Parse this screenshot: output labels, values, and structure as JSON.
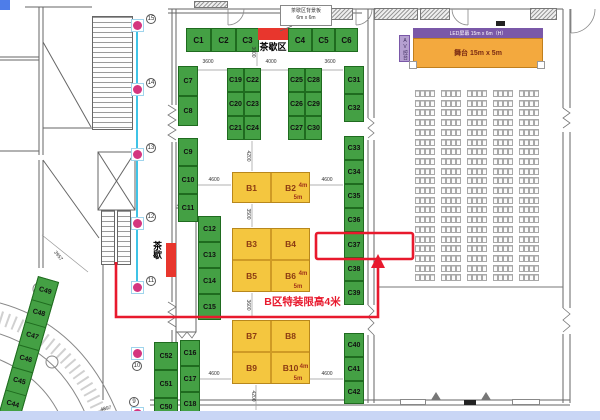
{
  "labels": {
    "tea_area": "茶歇区",
    "tea_annotation_line1": "茶歇区背景板",
    "tea_annotation_line2": "6m x 6m",
    "tea_side_vertical": "茶歇",
    "led_screen": "LED屏幕 15m x 6m（H）",
    "stage": "舞台 15m x 5m",
    "av_console": "AV控台",
    "height_limit_note": "B区特装限高4米"
  },
  "highlight": {
    "booth": "C37"
  },
  "colors": {
    "booth_green": "#44a044",
    "booth_yellow": "#f4c63f",
    "accent_red": "#e8192d",
    "marker_pink": "#d4367f",
    "marker_cyan": "#3fc3e6",
    "stage_orange": "#f3a93e",
    "led_purple": "#7a58a8",
    "bottom_bar": "#c9d6f5"
  },
  "green_booths": [
    {
      "id": "C1",
      "x": 186,
      "y": 28,
      "w": 25,
      "h": 24,
      "top": true
    },
    {
      "id": "C2",
      "x": 211,
      "y": 28,
      "w": 25,
      "h": 24,
      "top": true
    },
    {
      "id": "C3",
      "x": 236,
      "y": 28,
      "w": 23,
      "h": 24,
      "top": true
    },
    {
      "id": "C4",
      "x": 288,
      "y": 28,
      "w": 24,
      "h": 24,
      "top": true
    },
    {
      "id": "C5",
      "x": 312,
      "y": 28,
      "w": 23,
      "h": 24,
      "top": true
    },
    {
      "id": "C6",
      "x": 335,
      "y": 28,
      "w": 23,
      "h": 24,
      "top": true
    },
    {
      "id": "C7",
      "x": 178,
      "y": 66,
      "w": 20,
      "h": 30
    },
    {
      "id": "C8",
      "x": 178,
      "y": 96,
      "w": 20,
      "h": 30
    },
    {
      "id": "C9",
      "x": 178,
      "y": 138,
      "w": 20,
      "h": 28
    },
    {
      "id": "C10",
      "x": 178,
      "y": 166,
      "w": 20,
      "h": 28
    },
    {
      "id": "C11",
      "x": 178,
      "y": 194,
      "w": 20,
      "h": 28
    },
    {
      "id": "C12",
      "x": 198,
      "y": 216,
      "w": 23,
      "h": 26
    },
    {
      "id": "C13",
      "x": 198,
      "y": 242,
      "w": 23,
      "h": 26
    },
    {
      "id": "C14",
      "x": 198,
      "y": 268,
      "w": 23,
      "h": 26
    },
    {
      "id": "C15",
      "x": 198,
      "y": 294,
      "w": 23,
      "h": 26
    },
    {
      "id": "C16",
      "x": 180,
      "y": 340,
      "w": 20,
      "h": 26
    },
    {
      "id": "C17",
      "x": 180,
      "y": 366,
      "w": 20,
      "h": 26
    },
    {
      "id": "C18",
      "x": 180,
      "y": 392,
      "w": 20,
      "h": 24
    },
    {
      "id": "C52",
      "x": 154,
      "y": 342,
      "w": 24,
      "h": 28
    },
    {
      "id": "C51",
      "x": 154,
      "y": 370,
      "w": 24,
      "h": 28
    },
    {
      "id": "C50",
      "x": 154,
      "y": 398,
      "w": 24,
      "h": 18
    },
    {
      "id": "C19",
      "x": 227,
      "y": 68,
      "w": 17,
      "h": 24
    },
    {
      "id": "C22",
      "x": 244,
      "y": 68,
      "w": 17,
      "h": 24
    },
    {
      "id": "C20",
      "x": 227,
      "y": 92,
      "w": 17,
      "h": 24
    },
    {
      "id": "C23",
      "x": 244,
      "y": 92,
      "w": 17,
      "h": 24
    },
    {
      "id": "C21",
      "x": 227,
      "y": 116,
      "w": 17,
      "h": 24
    },
    {
      "id": "C24",
      "x": 244,
      "y": 116,
      "w": 17,
      "h": 24
    },
    {
      "id": "C25",
      "x": 288,
      "y": 68,
      "w": 17,
      "h": 24
    },
    {
      "id": "C28",
      "x": 305,
      "y": 68,
      "w": 17,
      "h": 24
    },
    {
      "id": "C26",
      "x": 288,
      "y": 92,
      "w": 17,
      "h": 24
    },
    {
      "id": "C29",
      "x": 305,
      "y": 92,
      "w": 17,
      "h": 24
    },
    {
      "id": "C27",
      "x": 288,
      "y": 116,
      "w": 17,
      "h": 24
    },
    {
      "id": "C30",
      "x": 305,
      "y": 116,
      "w": 17,
      "h": 24
    },
    {
      "id": "C31",
      "x": 344,
      "y": 66,
      "w": 20,
      "h": 28
    },
    {
      "id": "C32",
      "x": 344,
      "y": 94,
      "w": 20,
      "h": 28
    },
    {
      "id": "C33",
      "x": 344,
      "y": 136,
      "w": 20,
      "h": 24
    },
    {
      "id": "C34",
      "x": 344,
      "y": 160,
      "w": 20,
      "h": 24
    },
    {
      "id": "C35",
      "x": 344,
      "y": 184,
      "w": 20,
      "h": 24
    },
    {
      "id": "C36",
      "x": 344,
      "y": 208,
      "w": 20,
      "h": 24
    },
    {
      "id": "C37",
      "x": 344,
      "y": 232,
      "w": 20,
      "h": 26
    },
    {
      "id": "C38",
      "x": 344,
      "y": 258,
      "w": 20,
      "h": 23
    },
    {
      "id": "C39",
      "x": 344,
      "y": 281,
      "w": 20,
      "h": 24
    },
    {
      "id": "C40",
      "x": 344,
      "y": 333,
      "w": 20,
      "h": 24
    },
    {
      "id": "C41",
      "x": 344,
      "y": 357,
      "w": 20,
      "h": 24
    },
    {
      "id": "C42",
      "x": 344,
      "y": 381,
      "w": 20,
      "h": 23
    }
  ],
  "yellow_booths": [
    {
      "id": "B1",
      "x": 232,
      "y": 172,
      "w": 39,
      "h": 31
    },
    {
      "id": "B2",
      "x": 271,
      "y": 172,
      "w": 39,
      "h": 31
    },
    {
      "id": "B3",
      "x": 232,
      "y": 228,
      "w": 39,
      "h": 32
    },
    {
      "id": "B4",
      "x": 271,
      "y": 228,
      "w": 39,
      "h": 32
    },
    {
      "id": "B5",
      "x": 232,
      "y": 260,
      "w": 39,
      "h": 32
    },
    {
      "id": "B6",
      "x": 271,
      "y": 260,
      "w": 39,
      "h": 32
    },
    {
      "id": "B7",
      "x": 232,
      "y": 320,
      "w": 39,
      "h": 32
    },
    {
      "id": "B8",
      "x": 271,
      "y": 320,
      "w": 39,
      "h": 32
    },
    {
      "id": "B9",
      "x": 232,
      "y": 352,
      "w": 39,
      "h": 32
    },
    {
      "id": "B10",
      "x": 271,
      "y": 352,
      "w": 39,
      "h": 32
    }
  ],
  "yellow_blocks": [
    {
      "x": 232,
      "y": 172,
      "w": 78,
      "h": 31
    },
    {
      "x": 232,
      "y": 228,
      "w": 78,
      "h": 64
    },
    {
      "x": 232,
      "y": 320,
      "w": 78,
      "h": 64
    }
  ],
  "yellow_size_labels": [
    {
      "t": "4m",
      "x": 303,
      "y": 186
    },
    {
      "t": "5m",
      "x": 298,
      "y": 198
    },
    {
      "t": "4m",
      "x": 303,
      "y": 274
    },
    {
      "t": "5m",
      "x": 298,
      "y": 287
    },
    {
      "t": "4m",
      "x": 304,
      "y": 367
    },
    {
      "t": "5m",
      "x": 298,
      "y": 379
    }
  ],
  "diagonal_strip": {
    "labels": [
      "C49",
      "C48",
      "C47",
      "C46",
      "C45",
      "C44"
    ]
  },
  "route_markers": [
    {
      "n": "15",
      "y": 25,
      "lab": "right"
    },
    {
      "n": "14",
      "y": 89,
      "lab": "right"
    },
    {
      "n": "13",
      "y": 154,
      "lab": "right"
    },
    {
      "n": "12",
      "y": 223,
      "lab": "right"
    },
    {
      "n": "11",
      "y": 287,
      "lab": "right"
    },
    {
      "n": "10",
      "y": 353,
      "lab": "below"
    },
    {
      "n": "9",
      "y": 413,
      "lab": "above"
    }
  ],
  "dimensions": [
    {
      "t": "3600",
      "x": 208,
      "y": 62,
      "r": 0
    },
    {
      "t": "4000",
      "x": 271,
      "y": 62,
      "r": 0
    },
    {
      "t": "3600",
      "x": 330,
      "y": 62,
      "r": 0
    },
    {
      "t": "3000",
      "x": 253,
      "y": 52,
      "r": 90
    },
    {
      "t": "4200",
      "x": 248,
      "y": 156,
      "r": 90
    },
    {
      "t": "4600",
      "x": 214,
      "y": 180,
      "r": 0
    },
    {
      "t": "4600",
      "x": 327,
      "y": 180,
      "r": 0
    },
    {
      "t": "3500",
      "x": 248,
      "y": 214,
      "r": 90
    },
    {
      "t": "3600",
      "x": 248,
      "y": 305,
      "r": 90
    },
    {
      "t": "4600",
      "x": 214,
      "y": 374,
      "r": 0
    },
    {
      "t": "4600",
      "x": 327,
      "y": 374,
      "r": 0
    },
    {
      "t": "4200",
      "x": 253,
      "y": 396,
      "r": 90
    },
    {
      "t": "3957",
      "x": 58,
      "y": 256,
      "r": 52
    },
    {
      "t": "4897",
      "x": 106,
      "y": 409,
      "r": -12
    }
  ],
  "seating": {
    "groups": 5,
    "rows": 20,
    "seats_per_group": 4
  }
}
